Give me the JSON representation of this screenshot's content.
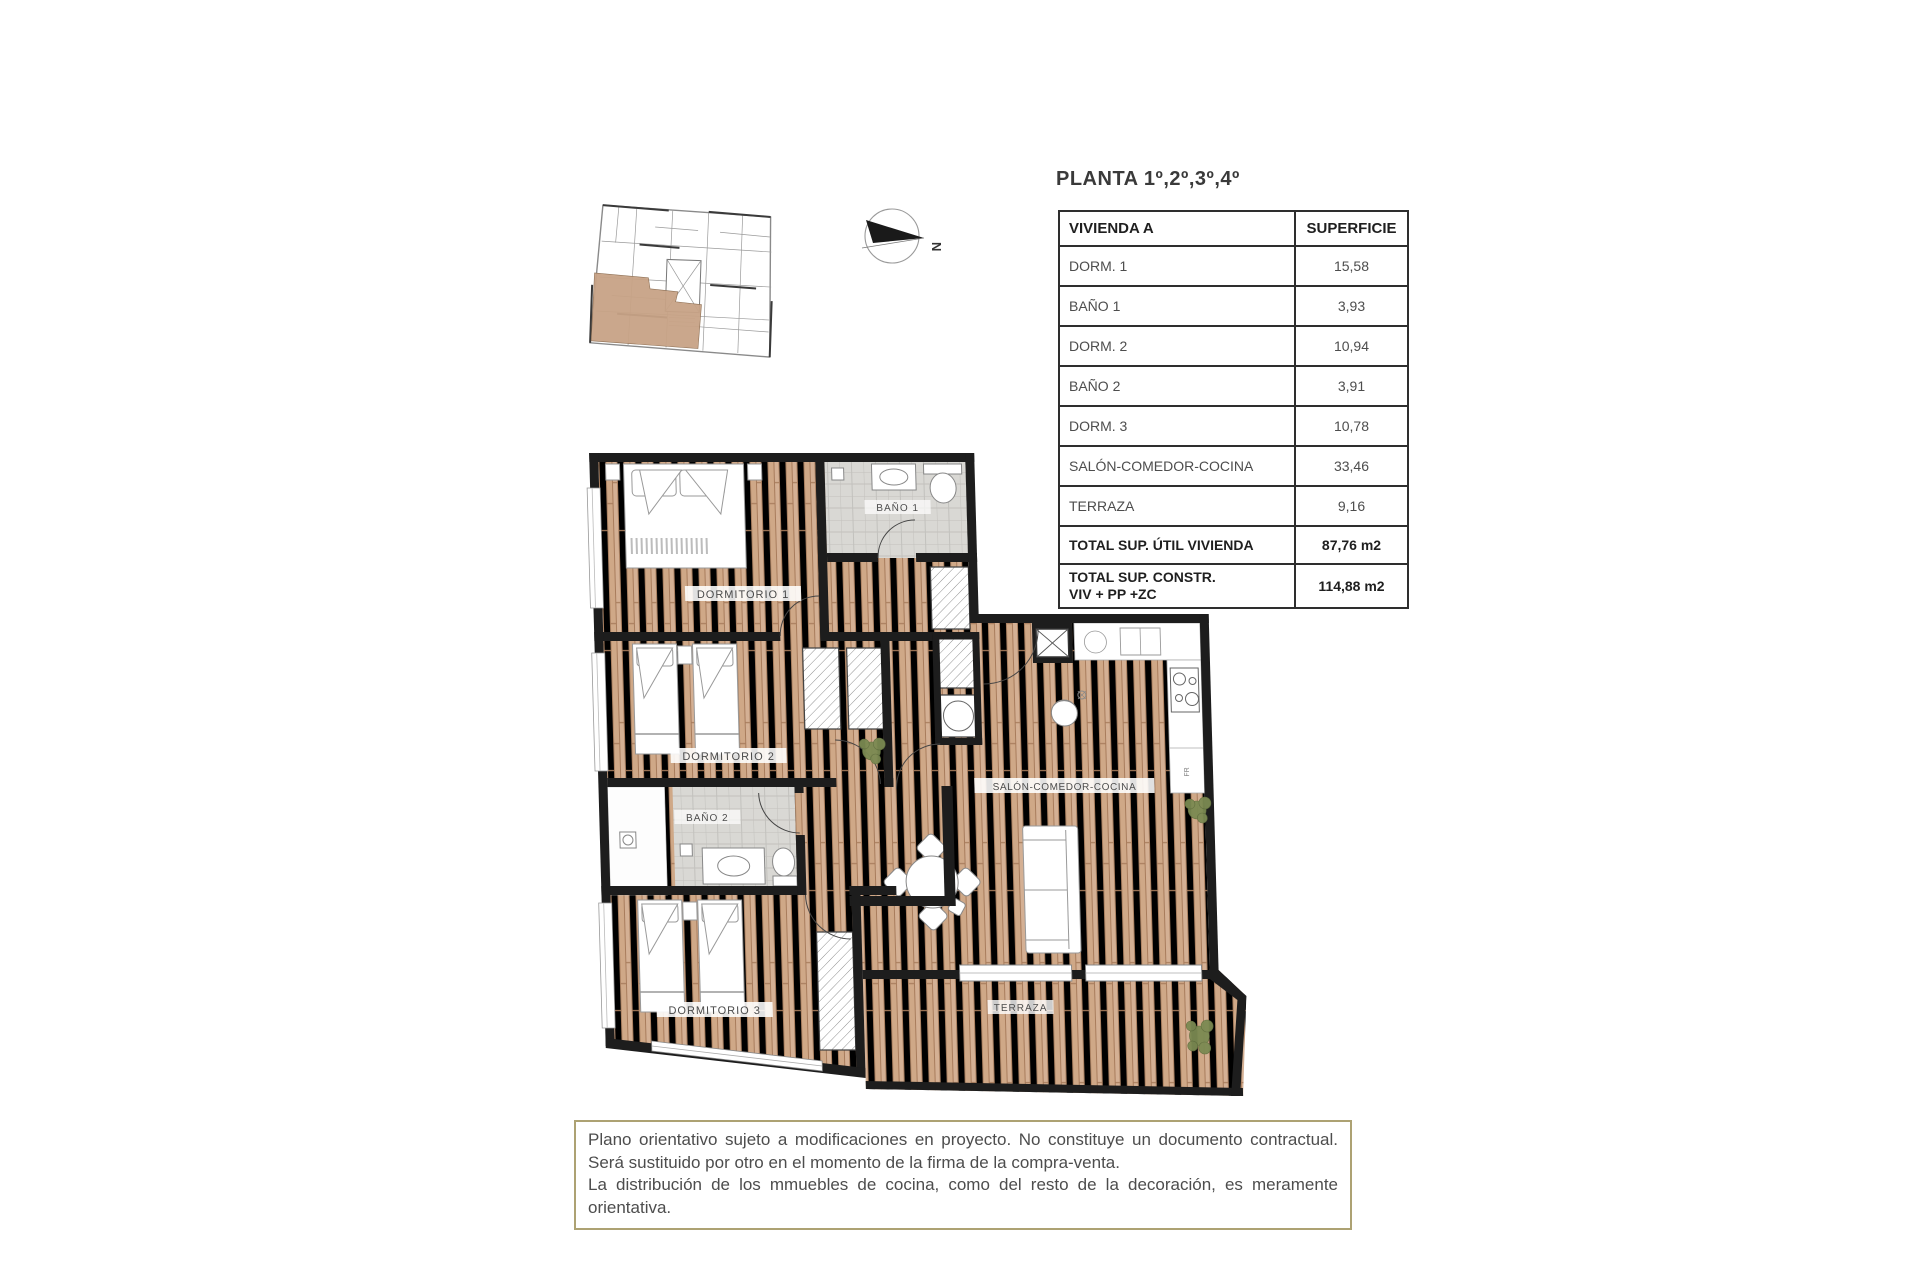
{
  "page": {
    "title": "PLANTA 1º,2º,3º,4º"
  },
  "table": {
    "headers": [
      "VIVIENDA A",
      "SUPERFICIE"
    ],
    "rows": [
      {
        "label": "DORM. 1",
        "value": "15,58"
      },
      {
        "label": "BAÑO 1",
        "value": "3,93"
      },
      {
        "label": "DORM. 2",
        "value": "10,94"
      },
      {
        "label": "BAÑO 2",
        "value": "3,91"
      },
      {
        "label": "DORM. 3",
        "value": "10,78"
      },
      {
        "label": "SALÓN-COMEDOR-COCINA",
        "value": "33,46"
      },
      {
        "label": "TERRAZA",
        "value": "9,16"
      }
    ],
    "totals": [
      {
        "label": "TOTAL SUP. ÚTIL VIVIENDA",
        "label2": "",
        "value": "87,76 m2"
      },
      {
        "label": "TOTAL SUP. CONSTR.",
        "label2": "VIV + PP +ZC",
        "value": "114,88 m2"
      }
    ]
  },
  "plan": {
    "labels": {
      "rooms": [
        "DORMITORIO 1",
        "BAÑO 1",
        "DORMITORIO 2",
        "BAÑO 2",
        "DORMITORIO 3",
        "SALÓN-COMEDOR-COCINA",
        "TERRAZA"
      ],
      "fridge": "FR"
    }
  },
  "compass": {
    "north": "N"
  },
  "disclaimer": {
    "line1": "Plano orientativo sujeto a modificaciones en proyecto. No constituye un documento contractual. Será sustituido por otro en el momento de la firma de la compra-venta.",
    "line2": "La distribución de los mmuebles de cocina, como del resto de la decoración, es meramente orientativa."
  },
  "colors": {
    "wood": "#c9a184",
    "wall": "#1d1d1d",
    "tile": "#d9d8d4",
    "unit_highlight": "#c8a386",
    "disclaimer_border": "#ada273"
  }
}
